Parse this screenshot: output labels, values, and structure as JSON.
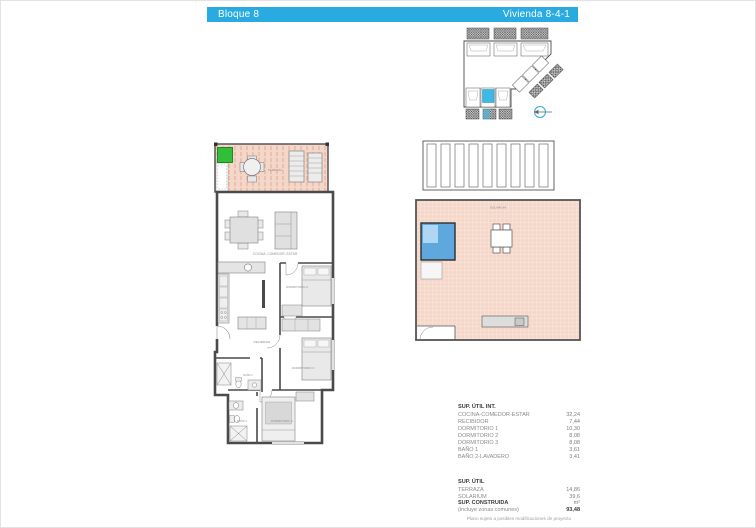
{
  "header": {
    "block_label": "Bloque 8",
    "unit_label": "Vivienda  8-4-1"
  },
  "colors": {
    "accent_cyan": "#29ABE2",
    "terrace_fill": "#F5D7C9",
    "terrace_hatch": "#D8997F",
    "pool_blue": "#5FA8DE",
    "pool_light": "#AFD6F2",
    "marker_green": "#2FBF3A",
    "wall_gray": "#4A4A4A"
  },
  "floor_plan": {
    "labels": {
      "terraza": "TERRAZA",
      "living": "COCINA, COMEDOR, ESTAR",
      "recibidor": "RECIBIDOR",
      "dorm1": "DORMITORIO 1",
      "dorm2": "DORMITORIO 2",
      "dorm3": "DORMITORIO 3",
      "bano1": "BAÑO 1",
      "bano2": "BAÑO 2",
      "solarium": "SOLARIUM"
    }
  },
  "areas": {
    "int_title": "SUP. ÚTIL INT.",
    "int_rows": [
      {
        "name": "COCINA-COMEDOR-ESTAR",
        "value": "32,24"
      },
      {
        "name": "RECIBIDOR",
        "value": "7,44"
      },
      {
        "name": "DORMITORIO 1",
        "value": "10,30"
      },
      {
        "name": "DORMITORIO 2",
        "value": "8,08"
      },
      {
        "name": "DORMITORIO 3",
        "value": "8,08"
      },
      {
        "name": "BAÑO 1",
        "value": "3,61"
      },
      {
        "name": "BAÑO 2-LAVADERO",
        "value": "3,41"
      }
    ],
    "util_title": "SUP. ÚTIL",
    "util_rows": [
      {
        "name": "TERRAZA",
        "value": "14,86"
      },
      {
        "name": "SOLARIUM",
        "value": "39,6"
      }
    ],
    "built_title": "SUP. CONSTRUIDA",
    "built_unit": "m²",
    "built_sub": "(incluye zonas comunes)",
    "built_value": "93,48"
  },
  "footer": {
    "note": "Plano sujeto a posibles modificaciones de proyecto"
  }
}
